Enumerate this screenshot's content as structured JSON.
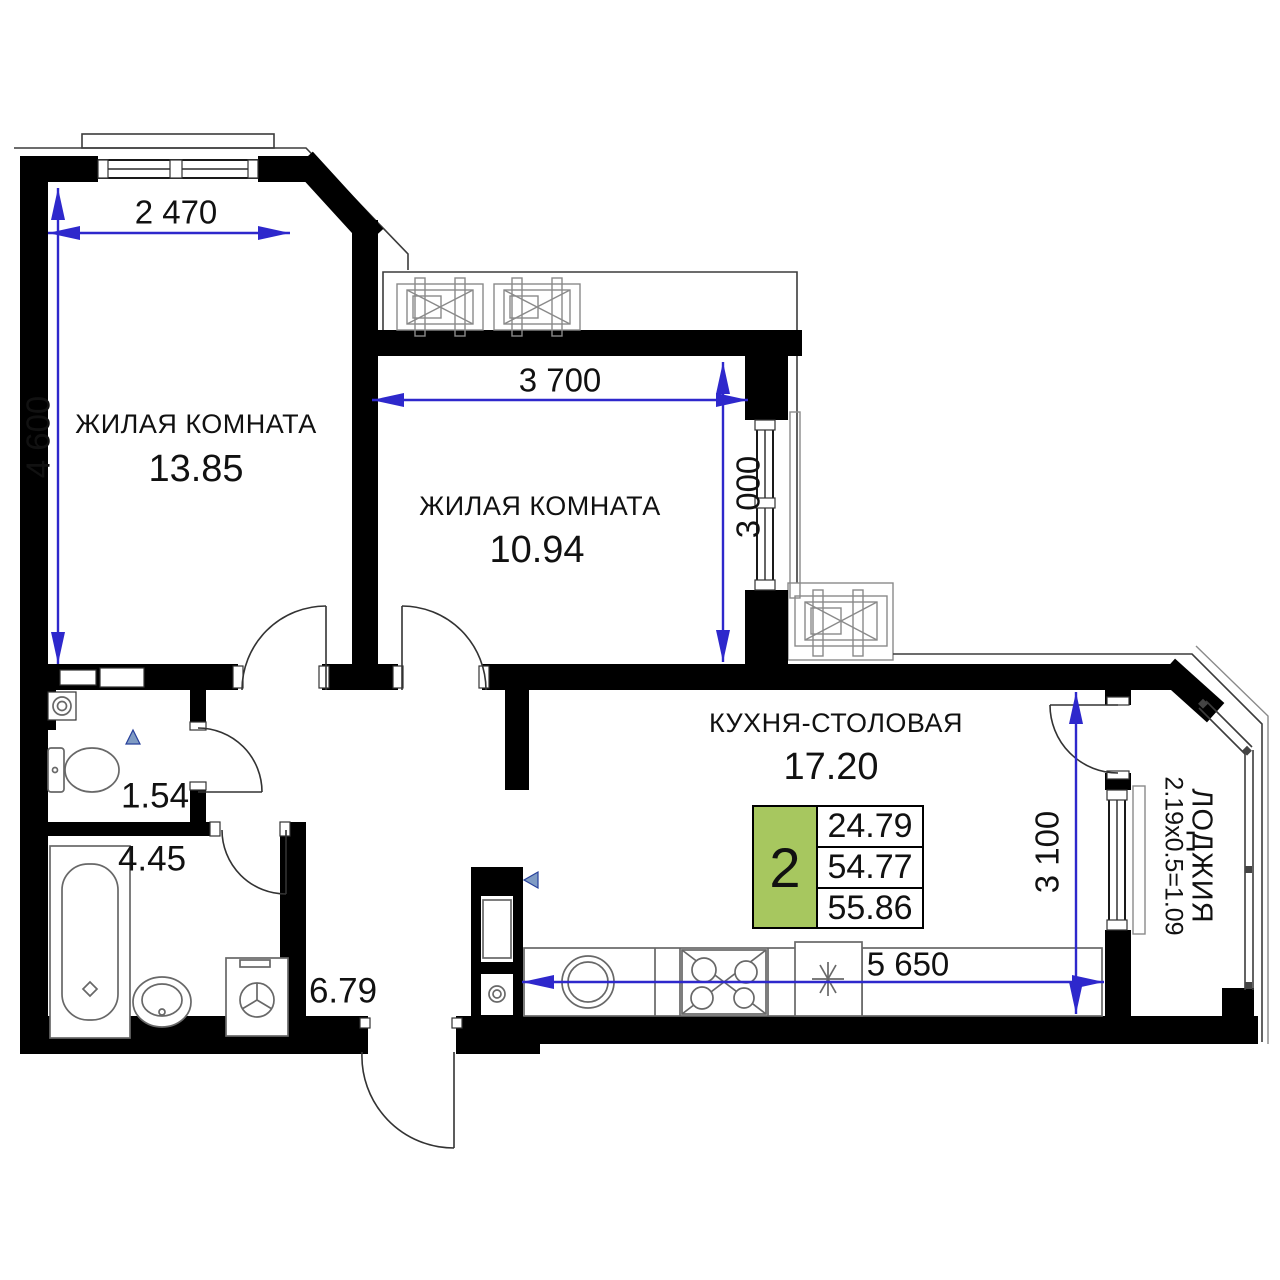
{
  "rooms": {
    "room1": {
      "name": "ЖИЛАЯ КОМНАТА",
      "area": "13.85"
    },
    "room2": {
      "name": "ЖИЛАЯ КОМНАТА",
      "area": "10.94"
    },
    "kitchen": {
      "name": "КУХНЯ-СТОЛОВАЯ",
      "area": "17.20"
    },
    "loggia": {
      "name": "ЛОДЖИЯ",
      "dims": "2.19х0.5=1.09"
    },
    "wc": {
      "area": "1.54"
    },
    "bathroom": {
      "area": "4.45"
    },
    "hallway": {
      "area": "6.79"
    }
  },
  "dimensions": {
    "room1_width": "2 470",
    "room1_height": "4 600",
    "room2_width": "3 700",
    "room2_height": "3 000",
    "kitchen_width": "5 650",
    "kitchen_height": "3 100"
  },
  "info_badge": {
    "room_count": "2",
    "living_area": "24.79",
    "floor_area": "54.77",
    "total_area": "55.86"
  },
  "colors": {
    "wall": "#000000",
    "dimension_line": "#2e28cc",
    "badge_green": "#a7c75f",
    "fixture_line": "#686868"
  }
}
